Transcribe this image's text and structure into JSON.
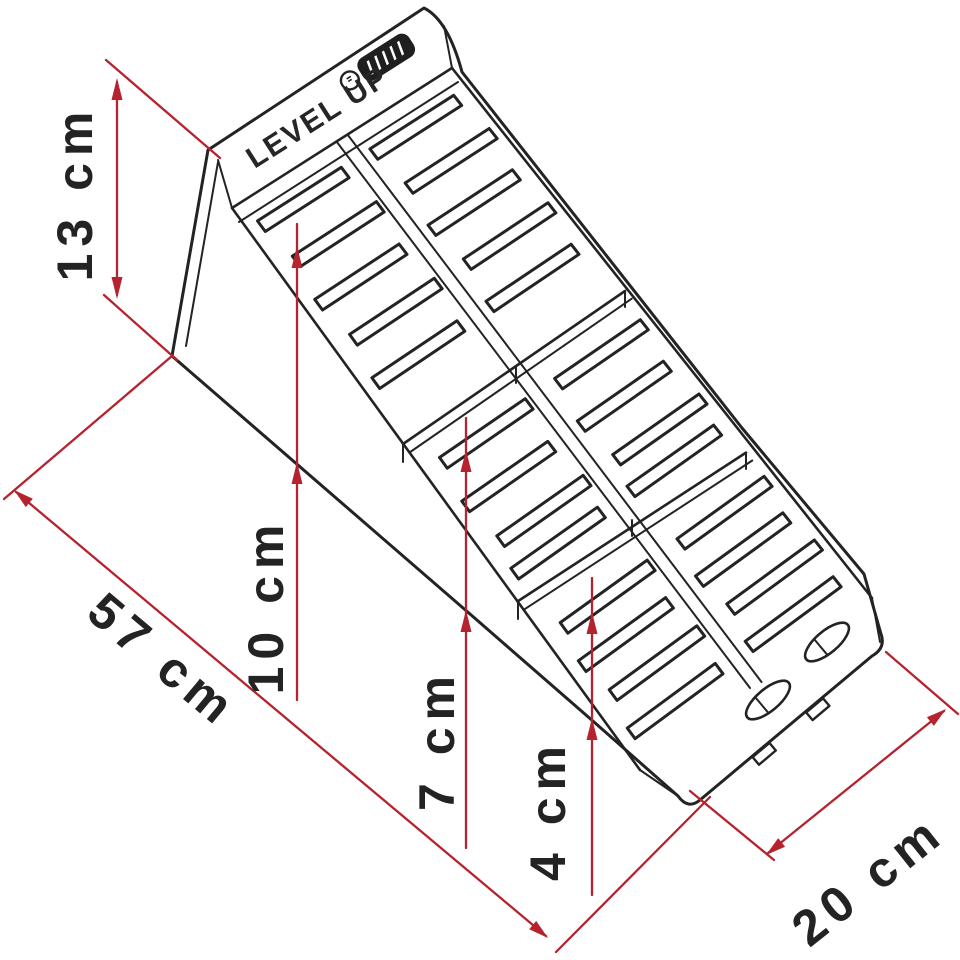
{
  "diagram": {
    "product_text": "LEVEL UP",
    "brand_logo": "fiamma",
    "dimensions": {
      "height": {
        "label": "13 cm"
      },
      "length": {
        "label": "57 cm"
      },
      "step_third": {
        "label": "10 cm"
      },
      "step_second": {
        "label": "7 cm"
      },
      "step_first": {
        "label": "4 cm"
      },
      "width": {
        "label": "20 cm"
      }
    },
    "colors": {
      "dimension_red": "#b5232e",
      "line_black": "#232323",
      "background": "#ffffff"
    }
  }
}
